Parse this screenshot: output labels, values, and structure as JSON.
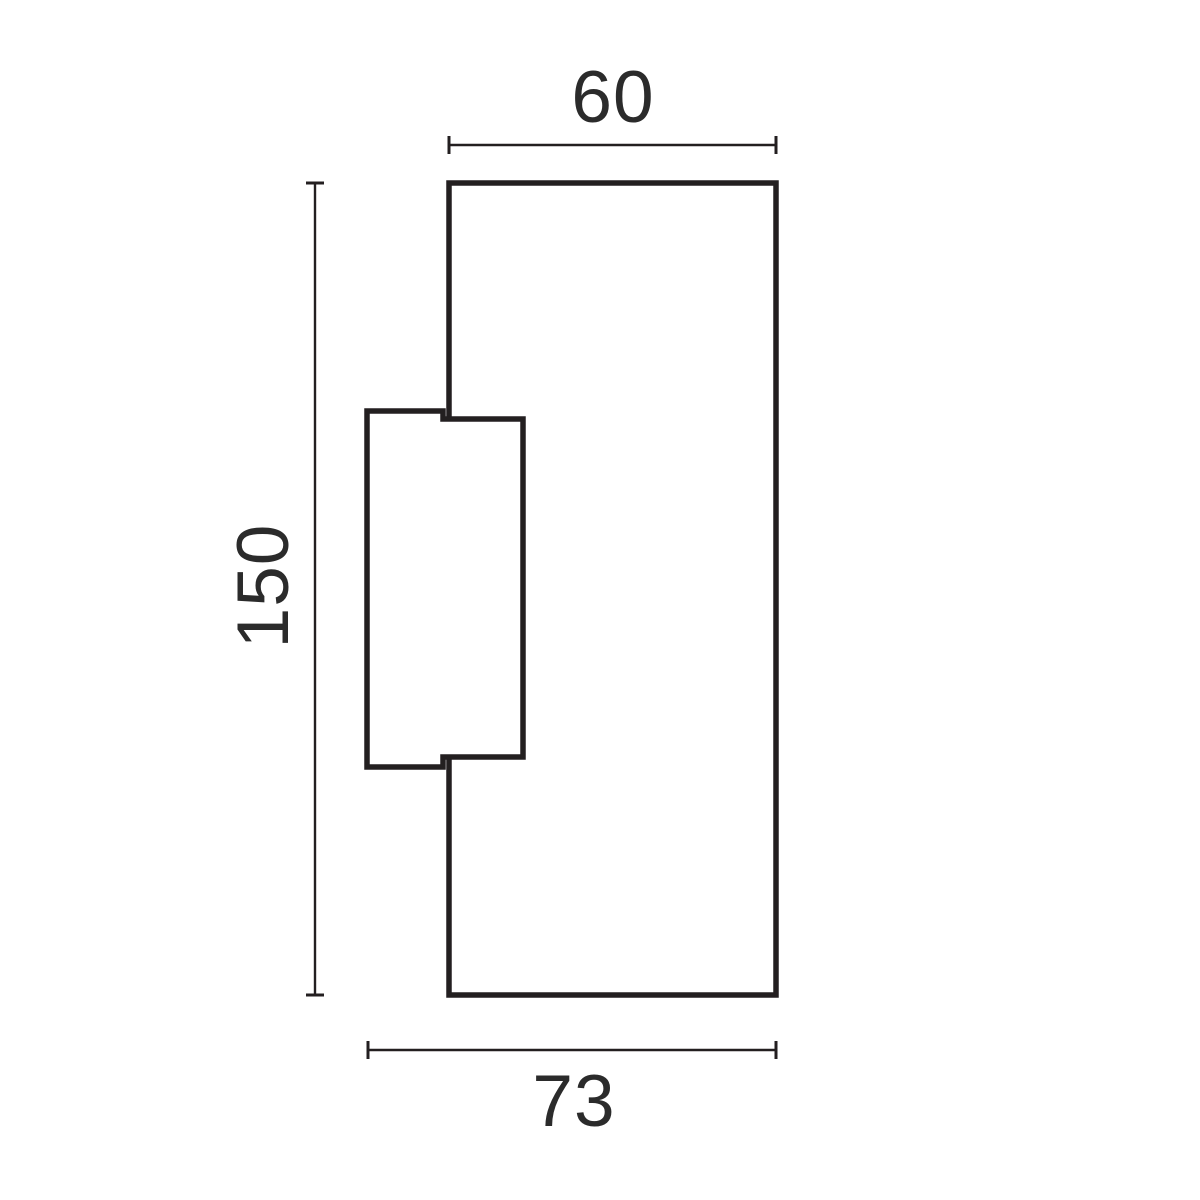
{
  "drawing": {
    "kind": "technical-dimension-drawing",
    "subject": "luminaire side profile with mounting bracket",
    "dimension_labels": {
      "top_width": "60",
      "left_height": "150",
      "bottom_depth": "73"
    }
  },
  "colors": {
    "line": "#231f20",
    "text": "#2b2b2b",
    "background": "#ffffff"
  }
}
